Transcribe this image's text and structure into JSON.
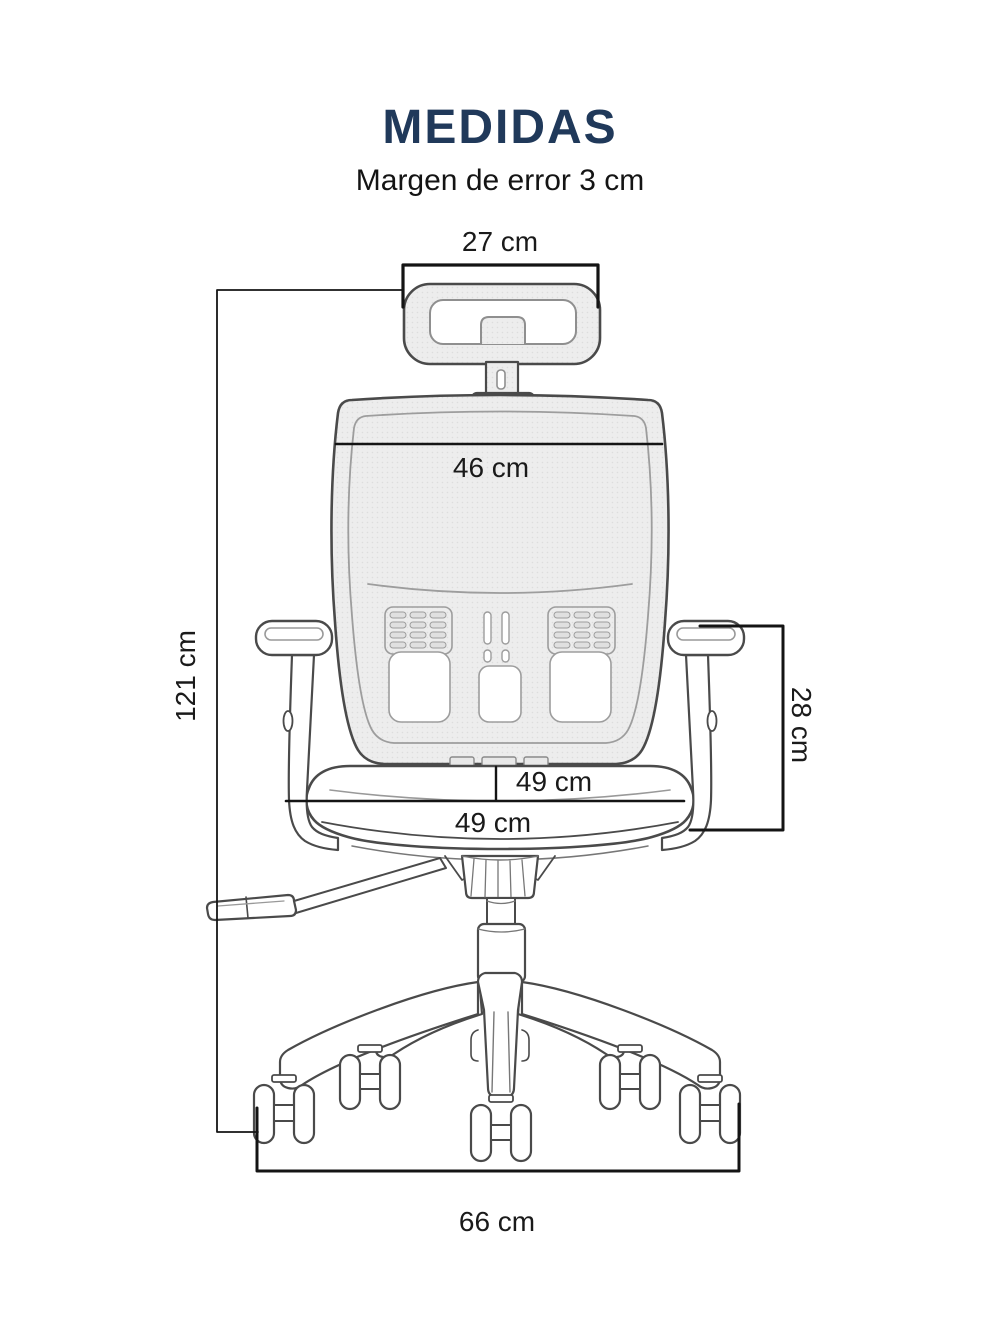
{
  "header": {
    "title": "MEDIDAS",
    "subtitle": "Margen de error 3 cm"
  },
  "diagram": {
    "subject": "office-chair-rear-view-line-drawing",
    "dimensions": [
      {
        "id": "headrest-width",
        "label": "27 cm",
        "orientation": "horizontal"
      },
      {
        "id": "backrest-width",
        "label": "46 cm",
        "orientation": "horizontal"
      },
      {
        "id": "total-height",
        "label": "121 cm",
        "orientation": "vertical"
      },
      {
        "id": "armrest-height",
        "label": "28 cm",
        "orientation": "vertical"
      },
      {
        "id": "seat-width-upper",
        "label": "49 cm",
        "orientation": "horizontal"
      },
      {
        "id": "seat-width-lower",
        "label": "49 cm",
        "orientation": "horizontal"
      },
      {
        "id": "base-width",
        "label": "66 cm",
        "orientation": "horizontal"
      }
    ]
  },
  "colors": {
    "title": "#20395a",
    "text": "#1a1a1a",
    "dimension_line": "#141414",
    "line_art": "#4a4a4a",
    "mesh_fill": "#ededed",
    "background": "#ffffff"
  }
}
